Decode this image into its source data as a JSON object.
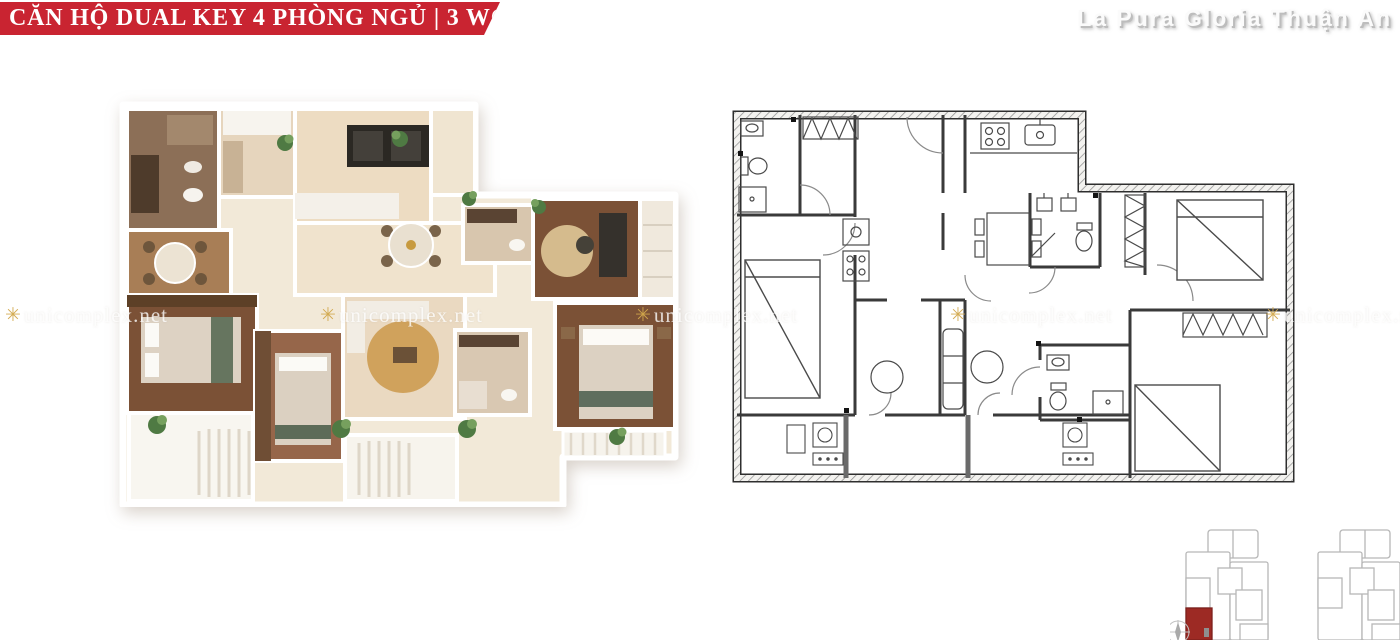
{
  "banner": {
    "title": "CĂN HỘ DUAL KEY 4 PHÒNG NGỦ | 3 WC",
    "background_color": "#c92431",
    "text_color": "#ffffff"
  },
  "project": {
    "name": "La Pura Gloria Thuận An",
    "text_color": "#fbfbfb",
    "shadow_color": "#bdbdbd"
  },
  "unit": {
    "type": "Dual Key",
    "bedrooms": 4,
    "wc": 3
  },
  "watermark": {
    "text": "unicomplex.net",
    "icon": "gold-starburst-icon",
    "icon_color": "#d2a84c",
    "row_top_px": 303,
    "positions_x_px": [
      5,
      320,
      635,
      950,
      1265
    ]
  },
  "floorplan_3d": {
    "description": "3D top-down furnished render of the dual key apartment",
    "wall_color": "#ffffff",
    "floor_light": "#f2e9d8",
    "floor_wood_dark": "#7b5136",
    "rug_gold": "#d0a25c",
    "plant_green": "#4f7a43"
  },
  "floorplan_2d": {
    "description": "2D architectural line drawing of the same dual key layout",
    "line_color": "#3a3a3a",
    "wall_hatch_color": "#909090"
  },
  "site_plan": {
    "buildings": 2,
    "outline_color": "#b7b7b7",
    "highlighted_unit_color": "#9d2a24",
    "compass": "compass-icon"
  }
}
